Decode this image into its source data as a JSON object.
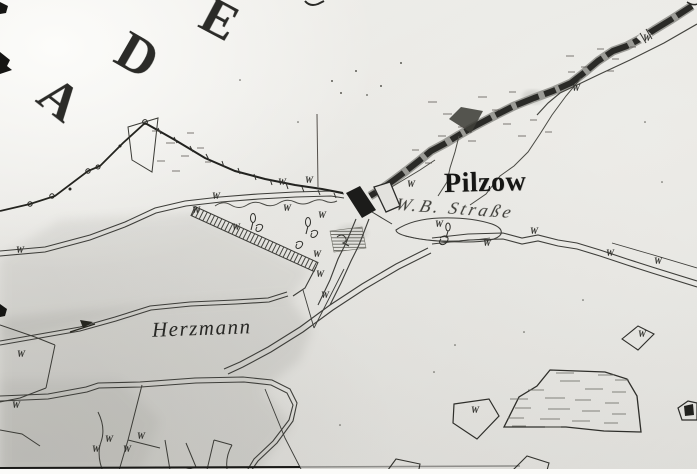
{
  "map": {
    "region_letters": [
      "A",
      "D",
      "E"
    ],
    "labels": {
      "place": "Pilzow",
      "stream": "W.B. Straße",
      "area": "Herzmann"
    },
    "symbols": {
      "meadow": "W"
    },
    "meadow_marks": [
      [
        16,
        253
      ],
      [
        192,
        213
      ],
      [
        212,
        199
      ],
      [
        232,
        230
      ],
      [
        278,
        185
      ],
      [
        283,
        211
      ],
      [
        305,
        183
      ],
      [
        318,
        218
      ],
      [
        313,
        257
      ],
      [
        316,
        277
      ],
      [
        321,
        298
      ],
      [
        407,
        187
      ],
      [
        435,
        227
      ],
      [
        483,
        246
      ],
      [
        530,
        234
      ],
      [
        606,
        256
      ],
      [
        654,
        264
      ],
      [
        572,
        91
      ],
      [
        643,
        41
      ],
      [
        638,
        337
      ],
      [
        471,
        413
      ],
      [
        17,
        357
      ],
      [
        12,
        408
      ],
      [
        137,
        439
      ],
      [
        123,
        452
      ],
      [
        105,
        442
      ],
      [
        92,
        452
      ]
    ],
    "colors": {
      "paper": "#e7e6e2",
      "ink": "#262624",
      "shade": "#6a6a64",
      "stream_dark": "#2a2a27"
    }
  }
}
